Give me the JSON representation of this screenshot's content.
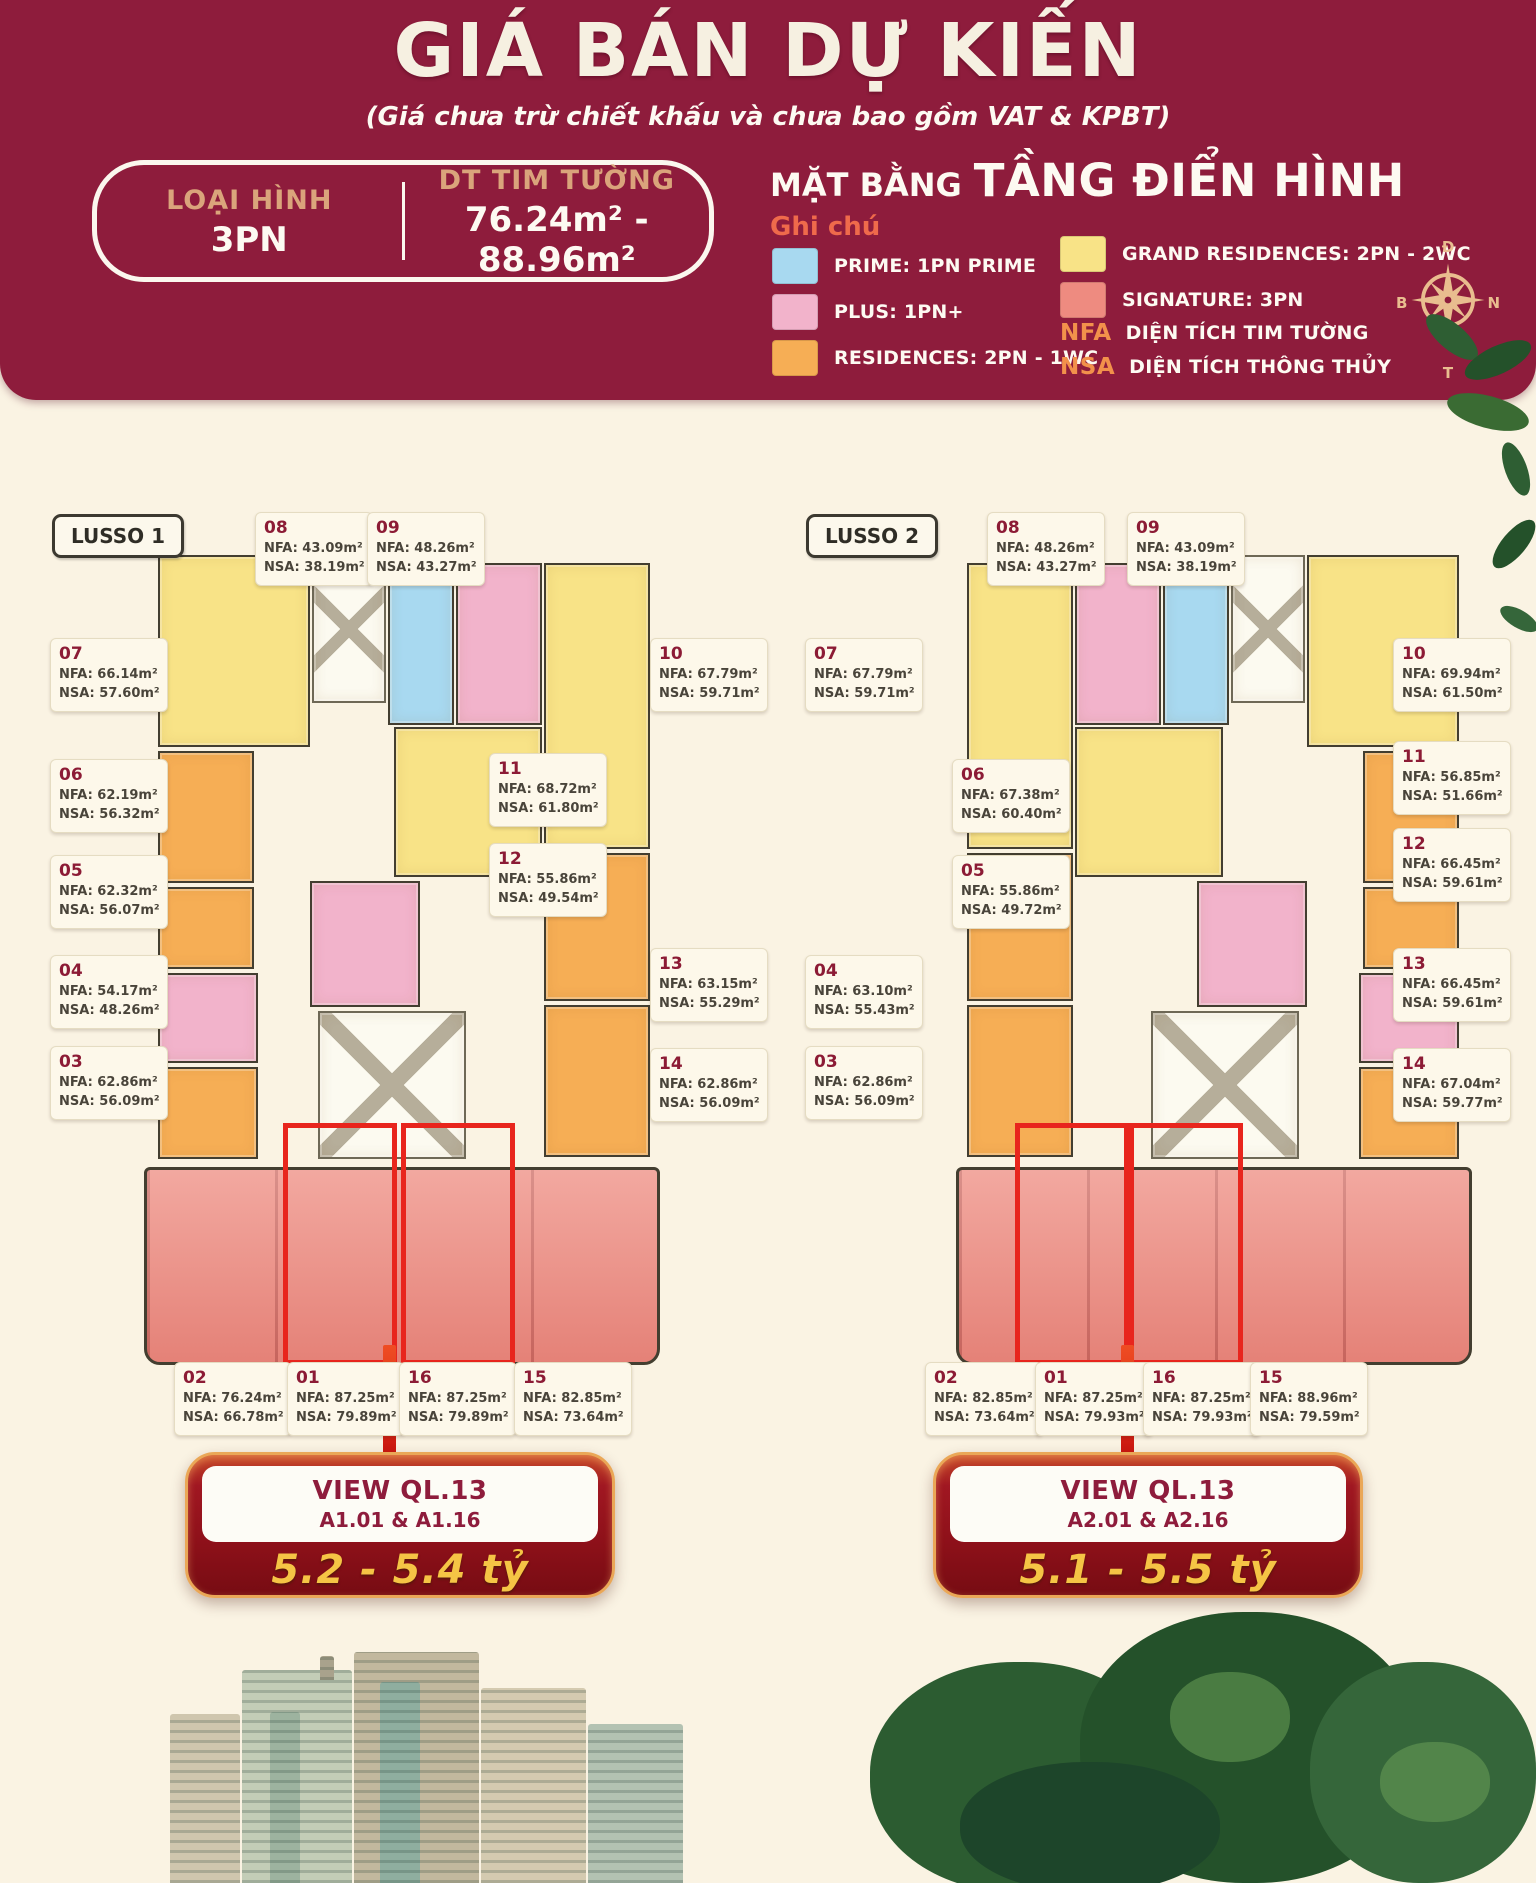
{
  "header": {
    "title": "GIÁ BÁN DỰ KIẾN",
    "subtitle": "(Giá chưa trừ chiết khấu và chưa bao gồm VAT & KPBT)",
    "info_box": {
      "type_label": "LOẠI HÌNH",
      "type_value": "3PN",
      "area_label": "DT TIM TƯỜNG",
      "area_value": "76.24m² - 88.96m²"
    },
    "plan_title_prefix": "MẶT BẰNG",
    "plan_title_main": "TẦNG ĐIỂN HÌNH",
    "legend_title": "Ghi chú",
    "legend": [
      {
        "label": "PRIME: 1PN PRIME",
        "color_key": "prime"
      },
      {
        "label": "PLUS: 1PN+",
        "color_key": "plus"
      },
      {
        "label": "RESIDENCES: 2PN - 1WC",
        "color_key": "residences"
      },
      {
        "label": "GRAND RESIDENCES: 2PN - 2WC",
        "color_key": "grand"
      },
      {
        "label": "SIGNATURE: 3PN",
        "color_key": "signature"
      }
    ],
    "abbreviations": [
      {
        "key": "NFA",
        "label": "DIỆN TÍCH TIM TƯỜNG"
      },
      {
        "key": "NSA",
        "label": "DIỆN TÍCH THÔNG THỦY"
      }
    ],
    "compass": {
      "top": "Đ",
      "right": "N",
      "bottom": "T",
      "left": "B"
    }
  },
  "colors": {
    "header_maroon": "#8e1c3c",
    "background_cream": "#faf3e3",
    "prime": "#a8d9f0",
    "plus": "#f2b3cb",
    "residences": "#f6ae55",
    "grand": "#f8e387",
    "signature": "#ee8b80",
    "highlight_red": "#e8251d",
    "price_gold": "#f5c445"
  },
  "unit_field_labels": {
    "nfa": "NFA:",
    "nsa": "NSA:"
  },
  "towers": [
    {
      "name": "LUSSO 1",
      "units": [
        {
          "id": "08",
          "nfa": "43.09m²",
          "nsa": "38.19m²"
        },
        {
          "id": "09",
          "nfa": "48.26m²",
          "nsa": "43.27m²"
        },
        {
          "id": "07",
          "nfa": "66.14m²",
          "nsa": "57.60m²"
        },
        {
          "id": "10",
          "nfa": "67.79m²",
          "nsa": "59.71m²"
        },
        {
          "id": "06",
          "nfa": "62.19m²",
          "nsa": "56.32m²"
        },
        {
          "id": "11",
          "nfa": "68.72m²",
          "nsa": "61.80m²"
        },
        {
          "id": "05",
          "nfa": "62.32m²",
          "nsa": "56.07m²"
        },
        {
          "id": "12",
          "nfa": "55.86m²",
          "nsa": "49.54m²"
        },
        {
          "id": "04",
          "nfa": "54.17m²",
          "nsa": "48.26m²"
        },
        {
          "id": "13",
          "nfa": "63.15m²",
          "nsa": "55.29m²"
        },
        {
          "id": "03",
          "nfa": "62.86m²",
          "nsa": "56.09m²"
        },
        {
          "id": "14",
          "nfa": "62.86m²",
          "nsa": "56.09m²"
        },
        {
          "id": "02",
          "nfa": "76.24m²",
          "nsa": "66.78m²"
        },
        {
          "id": "01",
          "nfa": "87.25m²",
          "nsa": "79.89m²"
        },
        {
          "id": "16",
          "nfa": "87.25m²",
          "nsa": "79.89m²"
        },
        {
          "id": "15",
          "nfa": "82.85m²",
          "nsa": "73.64m²"
        }
      ],
      "callout": {
        "view_label": "VIEW QL.13",
        "units_label": "A1.01 & A1.16",
        "price": "5.2 - 5.4 tỷ"
      }
    },
    {
      "name": "LUSSO 2",
      "units": [
        {
          "id": "08",
          "nfa": "48.26m²",
          "nsa": "43.27m²"
        },
        {
          "id": "09",
          "nfa": "43.09m²",
          "nsa": "38.19m²"
        },
        {
          "id": "07",
          "nfa": "67.79m²",
          "nsa": "59.71m²"
        },
        {
          "id": "10",
          "nfa": "69.94m²",
          "nsa": "61.50m²"
        },
        {
          "id": "06",
          "nfa": "67.38m²",
          "nsa": "60.40m²"
        },
        {
          "id": "11",
          "nfa": "56.85m²",
          "nsa": "51.66m²"
        },
        {
          "id": "05",
          "nfa": "55.86m²",
          "nsa": "49.72m²"
        },
        {
          "id": "12",
          "nfa": "66.45m²",
          "nsa": "59.61m²"
        },
        {
          "id": "04",
          "nfa": "63.10m²",
          "nsa": "55.43m²"
        },
        {
          "id": "13",
          "nfa": "66.45m²",
          "nsa": "59.61m²"
        },
        {
          "id": "03",
          "nfa": "62.86m²",
          "nsa": "56.09m²"
        },
        {
          "id": "14",
          "nfa": "67.04m²",
          "nsa": "59.77m²"
        },
        {
          "id": "02",
          "nfa": "82.85m²",
          "nsa": "73.64m²"
        },
        {
          "id": "01",
          "nfa": "87.25m²",
          "nsa": "79.93m²"
        },
        {
          "id": "16",
          "nfa": "87.25m²",
          "nsa": "79.93m²"
        },
        {
          "id": "15",
          "nfa": "88.96m²",
          "nsa": "79.59m²"
        }
      ],
      "callout": {
        "view_label": "VIEW QL.13",
        "units_label": "A2.01 & A2.16",
        "price": "5.1 - 5.5 tỷ"
      }
    }
  ]
}
